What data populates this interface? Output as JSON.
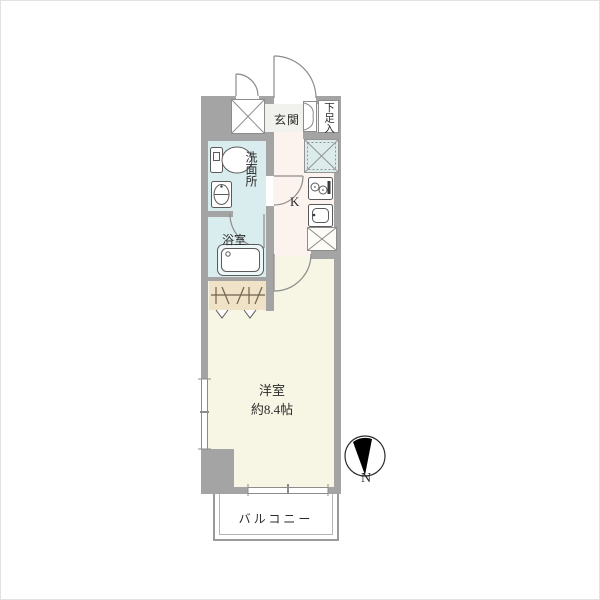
{
  "floorplan": {
    "rooms": {
      "genkan": {
        "label": "玄関"
      },
      "shoe_storage": {
        "label": "下足入"
      },
      "washroom": {
        "label": "洗面所"
      },
      "bathroom": {
        "label": "浴室"
      },
      "kitchen": {
        "label": "K"
      },
      "western_room": {
        "label": "洋室",
        "size": "約8.4帖"
      },
      "balcony": {
        "label": "バルコニー"
      }
    },
    "compass": {
      "north_label": "N"
    },
    "colors": {
      "wall": "#a4a4a4",
      "wet_area_floor": "#d9edef",
      "kitchen_floor": "#fcf3ef",
      "entrance_floor": "#f1f1ee",
      "room_floor": "#f7f5e3",
      "closet_floor": "#efe2c6",
      "laundry_space": "#dbeceb"
    }
  }
}
